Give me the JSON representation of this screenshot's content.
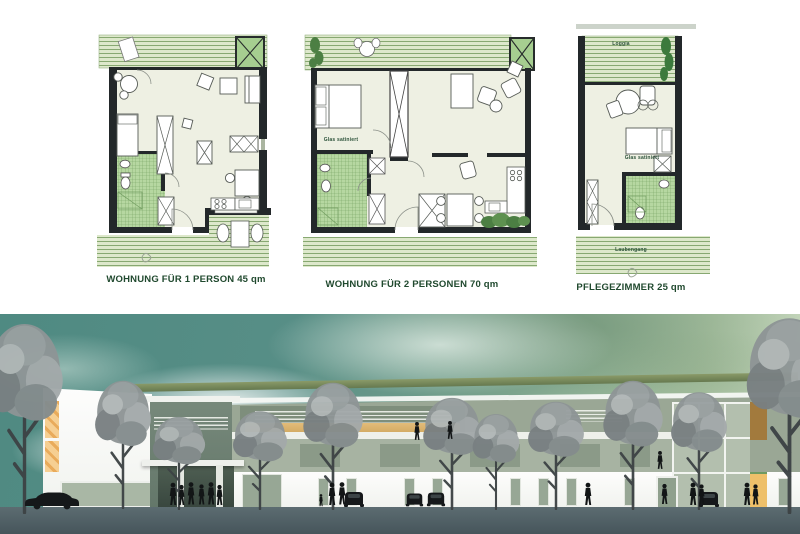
{
  "plans": {
    "plan1": {
      "label": "WOHNUNG FÜR 1 PERSON 45 qm"
    },
    "plan2": {
      "label": "WOHNUNG FÜR 2 PERSONEN 70 qm"
    },
    "plan3": {
      "label": "PFLEGEZIMMER 25 qm"
    }
  },
  "annotations": {
    "plan2_glas": "Glas satiniert",
    "plan3_loggia": "Loggia",
    "plan3_glas": "Glas satiniert",
    "plan3_laubengang": "Laubengang"
  },
  "colors": {
    "deck_green": "#dde8cb",
    "deck_line": "#87a871",
    "tile_green": "#b6d7a1",
    "planter_green": "#a6ce90",
    "wall_dark": "#23282a",
    "room_floor": "#eef0e3",
    "label_green": "#20492e",
    "sky_teal": "#57908a",
    "facade_sage": "#9aa795",
    "accent_orange": "#eec06a",
    "ground_gray": "#56666b"
  }
}
